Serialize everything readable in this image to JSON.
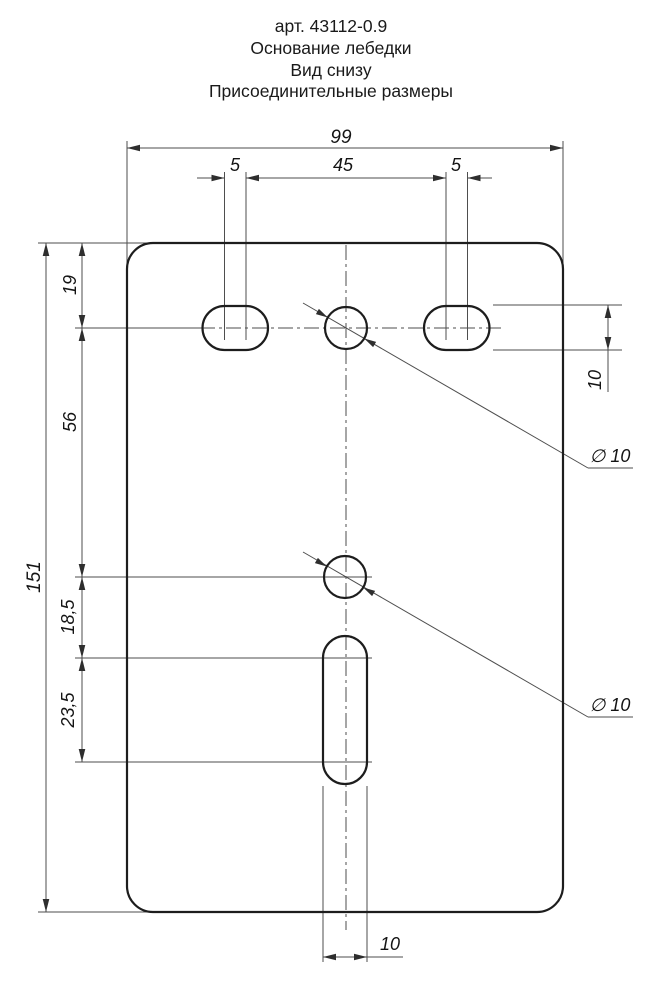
{
  "title": {
    "line1": "арт. 43112-0.9",
    "line2": "Основание лебедки",
    "line3": "Вид снизу",
    "line4": "Присоединительные размеры"
  },
  "dimensions": {
    "overall_width": "99",
    "slot_centers_left": "5",
    "holes_span": "45",
    "slot_centers_right": "5",
    "top_edge_to_holes": "19",
    "holes_to_middle_hole": "56",
    "middle_hole_to_slot": "18,5",
    "slot_centers_length": "23,5",
    "overall_height": "151",
    "slot_height_right": "10",
    "hole_diameter_top": "∅ 10",
    "hole_diameter_middle": "∅ 10",
    "slot_width_bottom": "10"
  }
}
